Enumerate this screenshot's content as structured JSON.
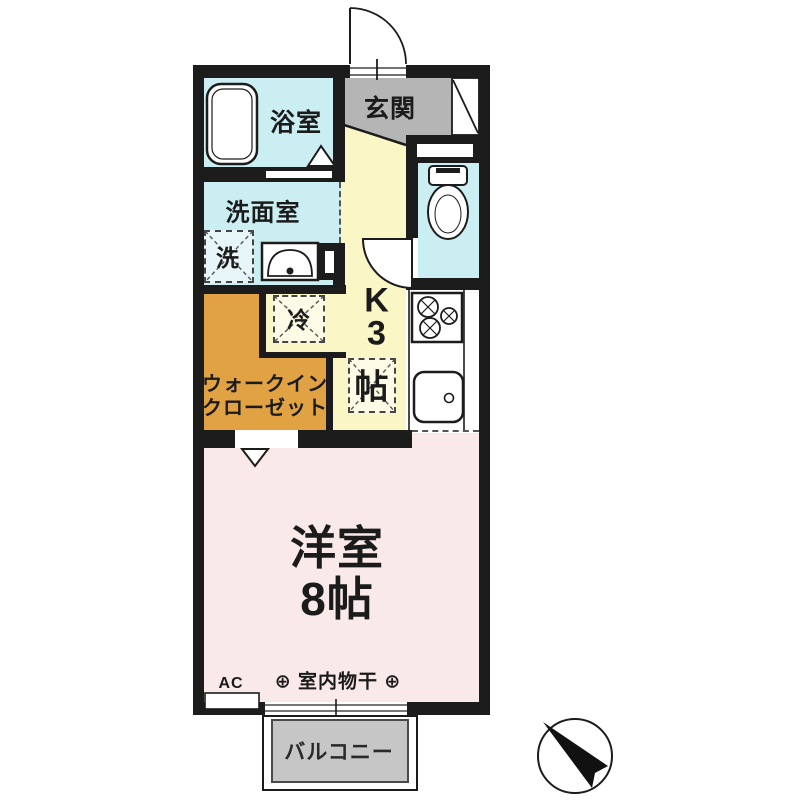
{
  "colors": {
    "paper": "#ffffff",
    "wall": "#1c1c1c",
    "wet": "#cbeef2",
    "kitchen": "#fbf6c5",
    "closet": "#e0a243",
    "bedroom": "#f9e9e8",
    "entrance": "#b5b5b5",
    "balcony": "#c6c6c6"
  },
  "rooms": {
    "bathroom": {
      "label": "浴室"
    },
    "washroom": {
      "label": "洗面室"
    },
    "washer": {
      "label": "洗"
    },
    "entrance": {
      "label": "玄関"
    },
    "kitchen": {
      "label_lines": [
        "K",
        "3",
        "帖"
      ]
    },
    "fridge": {
      "label": "冷"
    },
    "closet": {
      "label_line1": "ウォークイン",
      "label_line2": "クローゼット"
    },
    "western_room": {
      "label": "洋室",
      "size": "8帖",
      "ac": "AC",
      "drying": "⊕ 室内物干 ⊕"
    },
    "balcony": {
      "label": "バルコニー"
    }
  }
}
